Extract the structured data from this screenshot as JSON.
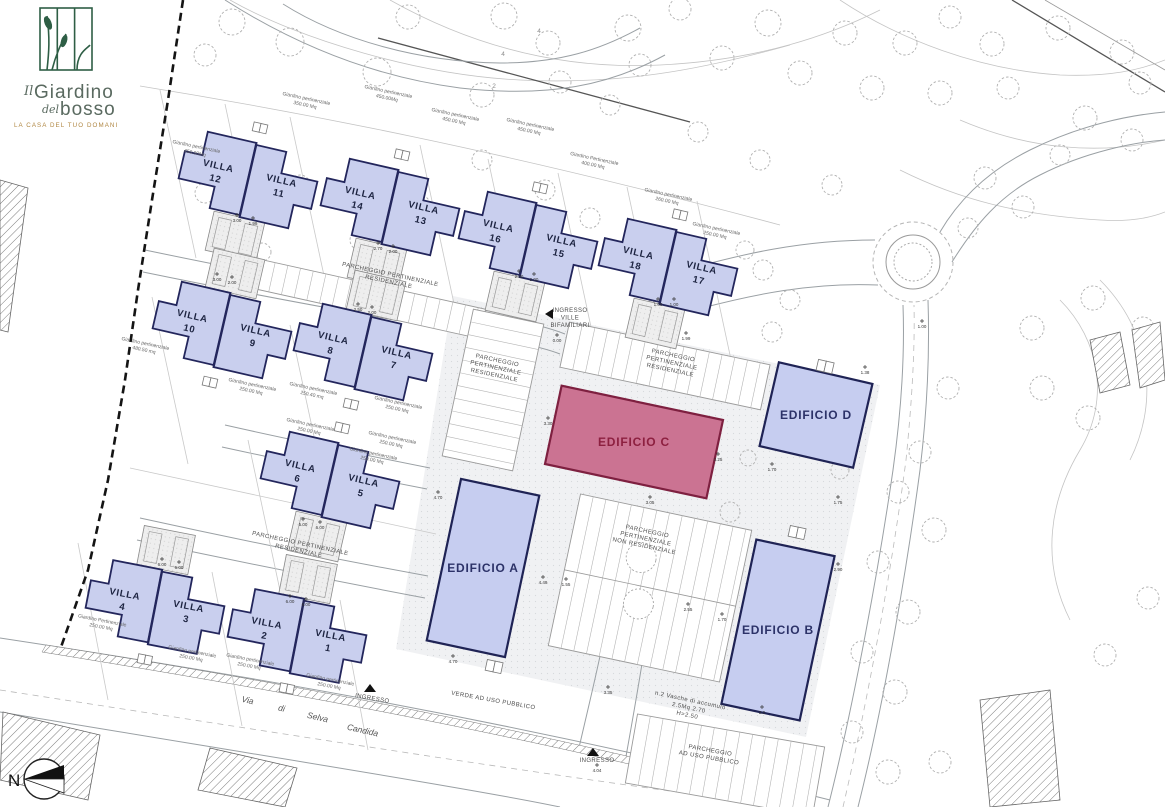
{
  "logo": {
    "prefix": "Il",
    "title": "Giardino",
    "mid": "del",
    "last": "bosso",
    "tagline": "LA CASA DEL TUO DOMANI",
    "brand_green": "#2e5e45",
    "brand_text": "#5a6a60",
    "brand_gold": "#b08743"
  },
  "compass": {
    "north": "N"
  },
  "street": {
    "words": [
      {
        "t": "Via",
        "x": 247,
        "y": 703,
        "rot": 13
      },
      {
        "t": "di",
        "x": 281,
        "y": 711,
        "rot": 13
      },
      {
        "t": "Selva",
        "x": 317,
        "y": 720,
        "rot": 13
      },
      {
        "t": "Candida",
        "x": 362,
        "y": 733,
        "rot": 13
      }
    ]
  },
  "colors": {
    "villa_fill": "#c9cfee",
    "villa_stroke": "#23265c",
    "edificio_blue": "#c6cdf0",
    "edificio_blue_stroke": "#1f2355",
    "edificio_blue_text": "#2c3268",
    "edificio_pink": "#cb7392",
    "edificio_pink_stroke": "#7e2040",
    "edificio_pink_text": "#8d2040",
    "plan_text": "#555555",
    "villa_text": "#1c2340"
  },
  "villa_pairs": [
    {
      "left": {
        "name": "VILLA",
        "num": "12"
      },
      "right": {
        "name": "VILLA",
        "num": "11"
      },
      "x": 248,
      "y": 180,
      "rot": 13,
      "parking": "below"
    },
    {
      "left": {
        "name": "VILLA",
        "num": "14"
      },
      "right": {
        "name": "VILLA",
        "num": "13"
      },
      "x": 390,
      "y": 207,
      "rot": 13,
      "parking": "below"
    },
    {
      "left": {
        "name": "VILLA",
        "num": "16"
      },
      "right": {
        "name": "VILLA",
        "num": "15"
      },
      "x": 528,
      "y": 240,
      "rot": 13,
      "parking": "below"
    },
    {
      "left": {
        "name": "VILLA",
        "num": "18"
      },
      "right": {
        "name": "VILLA",
        "num": "17"
      },
      "x": 668,
      "y": 267,
      "rot": 13,
      "parking": "below"
    },
    {
      "left": {
        "name": "VILLA",
        "num": "10"
      },
      "right": {
        "name": "VILLA",
        "num": "9"
      },
      "x": 222,
      "y": 330,
      "rot": 13,
      "parking": "above"
    },
    {
      "left": {
        "name": "VILLA",
        "num": "8"
      },
      "right": {
        "name": "VILLA",
        "num": "7"
      },
      "x": 363,
      "y": 352,
      "rot": 13,
      "parking": "above"
    },
    {
      "left": {
        "name": "VILLA",
        "num": "6"
      },
      "right": {
        "name": "VILLA",
        "num": "5"
      },
      "x": 330,
      "y": 480,
      "rot": 13,
      "parking": "below"
    },
    {
      "left": {
        "name": "VILLA",
        "num": "4"
      },
      "right": {
        "name": "VILLA",
        "num": "3"
      },
      "x": 155,
      "y": 607,
      "rot": 11,
      "parking": "above"
    },
    {
      "left": {
        "name": "VILLA",
        "num": "2"
      },
      "right": {
        "name": "VILLA",
        "num": "1"
      },
      "x": 297,
      "y": 636,
      "rot": 11,
      "parking": "above"
    }
  ],
  "edifici": [
    {
      "label": "EDIFICIO A",
      "x": 483,
      "y": 568,
      "w": 80,
      "h": 165,
      "rot": 12,
      "color": "blue"
    },
    {
      "label": "EDIFICIO B",
      "x": 778,
      "y": 630,
      "w": 80,
      "h": 168,
      "rot": 12,
      "color": "blue"
    },
    {
      "label": "EDIFICIO C",
      "x": 634,
      "y": 442,
      "w": 165,
      "h": 80,
      "rot": 12,
      "color": "pink"
    },
    {
      "label": "EDIFICIO D",
      "x": 816,
      "y": 415,
      "w": 96,
      "h": 86,
      "rot": 13,
      "color": "blue"
    }
  ],
  "garden_labels": [
    {
      "x": 196,
      "y": 148,
      "rot": 12,
      "line1": "Giardino pertinenziale",
      "line2": "450.00Mq"
    },
    {
      "x": 306,
      "y": 100,
      "rot": 12,
      "line1": "Giardino pertinenziale",
      "line2": "350.00 Mq"
    },
    {
      "x": 388,
      "y": 93,
      "rot": 12,
      "line1": "Giardino pertinenziale",
      "line2": "450.00Mq"
    },
    {
      "x": 455,
      "y": 116,
      "rot": 12,
      "line1": "Giardino pertinenziale",
      "line2": "450.00 Mq"
    },
    {
      "x": 530,
      "y": 126,
      "rot": 12,
      "line1": "Giardino pertinenziale",
      "line2": "450.00 Mq"
    },
    {
      "x": 594,
      "y": 160,
      "rot": 12,
      "line1": "Giardino Pertinenziale",
      "line2": "400.00 Mq"
    },
    {
      "x": 668,
      "y": 196,
      "rot": 12,
      "line1": "Giardino pertinenziale",
      "line2": "260.00 Mq"
    },
    {
      "x": 716,
      "y": 230,
      "rot": 12,
      "line1": "Giardino pertinenziale",
      "line2": "250.00 Mq"
    },
    {
      "x": 145,
      "y": 345,
      "rot": 12,
      "line1": "Giardino pertinenziale",
      "line2": "480.50 mq"
    },
    {
      "x": 252,
      "y": 386,
      "rot": 12,
      "line1": "Giardino pertinenziale",
      "line2": "250.00 Mq"
    },
    {
      "x": 313,
      "y": 390,
      "rot": 12,
      "line1": "Giardino pertinenziale",
      "line2": "250.40 mq"
    },
    {
      "x": 398,
      "y": 404,
      "rot": 12,
      "line1": "Giardino pertinenziale",
      "line2": "250.00 Mq"
    },
    {
      "x": 310,
      "y": 426,
      "rot": 12,
      "line1": "Giardino pertinenziale",
      "line2": "250.00 Mq"
    },
    {
      "x": 392,
      "y": 439,
      "rot": 12,
      "line1": "Giardino pertinenziale",
      "line2": "250.00 Mq"
    },
    {
      "x": 373,
      "y": 455,
      "rot": 12,
      "line1": "Giardino pertinenziale",
      "line2": "250.00 Mq"
    },
    {
      "x": 102,
      "y": 622,
      "rot": 11,
      "line1": "Giardino Pertinenziale",
      "line2": "250.00 Mq"
    },
    {
      "x": 192,
      "y": 653,
      "rot": 11,
      "line1": "Giardino pertinenziale",
      "line2": "250.00 Mq"
    },
    {
      "x": 250,
      "y": 661,
      "rot": 11,
      "line1": "Giardino pertinenziale",
      "line2": "250.00 Mq"
    },
    {
      "x": 330,
      "y": 681,
      "rot": 11,
      "line1": "Giardino pertinenziale",
      "line2": "250.00 Mq"
    }
  ],
  "zone_labels": [
    {
      "x": 390,
      "y": 276,
      "rot": 12,
      "lines": [
        "PARCHEGGIO PERTINENZIALE",
        "RESIDENZIALE"
      ]
    },
    {
      "x": 497,
      "y": 362,
      "rot": 12,
      "lines": [
        "PARCHEGGIO",
        "PERTINENZIALE",
        "RESIDENZIALE"
      ]
    },
    {
      "x": 673,
      "y": 357,
      "rot": 12,
      "lines": [
        "PARCHEGGIO",
        "PERTINENZIALE",
        "RESIDENZIALE"
      ]
    },
    {
      "x": 647,
      "y": 533,
      "rot": 12,
      "lines": [
        "PARCHEGGIO",
        "PERTINENZIALE",
        "NON RESIDENZIALE"
      ]
    },
    {
      "x": 710,
      "y": 752,
      "rot": 10,
      "lines": [
        "PARCHEGGIO",
        "AD USO PUBBLICO"
      ]
    },
    {
      "x": 493,
      "y": 702,
      "rot": 10,
      "lines": [
        "VERDE AD USO PUBBLICO"
      ]
    },
    {
      "x": 300,
      "y": 545,
      "rot": 12,
      "lines": [
        "PARCHEGGIO PERTINENZIALE",
        "RESIDENZIALE"
      ]
    },
    {
      "x": 570,
      "y": 312,
      "rot": 0,
      "lines": [
        "INGRESSO",
        "VILLE",
        "BIFAMILIARI"
      ]
    },
    {
      "x": 597,
      "y": 762,
      "rot": 0,
      "lines": [
        "INGRESSO"
      ]
    },
    {
      "x": 372,
      "y": 700,
      "rot": 10,
      "lines": [
        "INGRESSO"
      ]
    },
    {
      "x": 690,
      "y": 702,
      "rot": 12,
      "lines": [
        "n.2 Vasche di accumulo",
        "2.5Mq 2.70",
        "H=2.50"
      ]
    }
  ],
  "dims": [
    {
      "x": 557,
      "y": 342,
      "v": "0.00"
    },
    {
      "x": 658,
      "y": 306,
      "v": "1.00"
    },
    {
      "x": 674,
      "y": 306,
      "v": "1.00"
    },
    {
      "x": 686,
      "y": 340,
      "v": "1.99"
    },
    {
      "x": 548,
      "y": 425,
      "v": "3.30"
    },
    {
      "x": 718,
      "y": 461,
      "v": "3.25"
    },
    {
      "x": 650,
      "y": 504,
      "v": "3.05"
    },
    {
      "x": 438,
      "y": 499,
      "v": "4.70"
    },
    {
      "x": 453,
      "y": 663,
      "v": "4.70"
    },
    {
      "x": 543,
      "y": 584,
      "v": "4.49"
    },
    {
      "x": 566,
      "y": 586,
      "v": "1.55"
    },
    {
      "x": 688,
      "y": 611,
      "v": "2.55"
    },
    {
      "x": 922,
      "y": 328,
      "v": "1.00"
    },
    {
      "x": 865,
      "y": 374,
      "v": "1.38"
    },
    {
      "x": 772,
      "y": 471,
      "v": "1.70"
    },
    {
      "x": 838,
      "y": 504,
      "v": "1.75"
    },
    {
      "x": 722,
      "y": 621,
      "v": "1.70"
    },
    {
      "x": 838,
      "y": 571,
      "v": "2.90"
    },
    {
      "x": 762,
      "y": 714,
      "v": "2.0"
    },
    {
      "x": 608,
      "y": 694,
      "v": "3.35"
    },
    {
      "x": 237,
      "y": 222,
      "v": "3.00"
    },
    {
      "x": 253,
      "y": 225,
      "v": "1.99"
    },
    {
      "x": 378,
      "y": 250,
      "v": "2.70"
    },
    {
      "x": 393,
      "y": 253,
      "v": "2.00"
    },
    {
      "x": 519,
      "y": 278,
      "v": "2.30"
    },
    {
      "x": 534,
      "y": 281,
      "v": "2.00"
    },
    {
      "x": 217,
      "y": 281,
      "v": "3.00"
    },
    {
      "x": 232,
      "y": 284,
      "v": "2.00"
    },
    {
      "x": 358,
      "y": 311,
      "v": "2.50"
    },
    {
      "x": 372,
      "y": 314,
      "v": "2.00"
    },
    {
      "x": 303,
      "y": 526,
      "v": "5.00"
    },
    {
      "x": 320,
      "y": 529,
      "v": "6.00"
    },
    {
      "x": 162,
      "y": 566,
      "v": "6.00"
    },
    {
      "x": 179,
      "y": 569,
      "v": "6.00"
    },
    {
      "x": 290,
      "y": 603,
      "v": "6.00"
    },
    {
      "x": 306,
      "y": 606,
      "v": "6.00"
    },
    {
      "x": 597,
      "y": 772,
      "v": "4.04"
    }
  ],
  "contour_labels": [
    {
      "x": 503,
      "y": 56,
      "v": "4"
    },
    {
      "x": 494,
      "y": 88,
      "v": "2"
    },
    {
      "x": 539,
      "y": 33,
      "v": "4"
    }
  ]
}
